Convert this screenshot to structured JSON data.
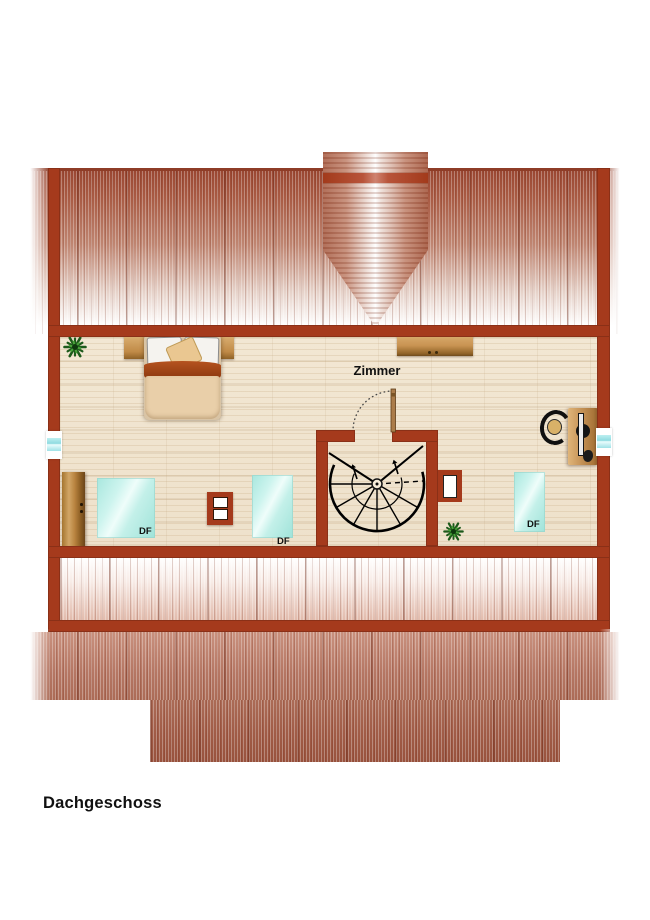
{
  "title": "Dachgeschoss",
  "room": {
    "label": "Zimmer"
  },
  "skylights": [
    {
      "label": "DF"
    },
    {
      "label": "DF"
    },
    {
      "label": "DF"
    }
  ],
  "icons": {
    "plant_1": "plant-icon",
    "plant_2": "plant-icon",
    "staircase": "spiral-staircase-icon",
    "door_swing": "door-swing-icon"
  },
  "colors": {
    "wall": "#a53a1c",
    "roof_dark": "#9a4732",
    "roof_light": "#e6d2c9",
    "floor": "#f1e6d2",
    "skylight": "#bfece6",
    "wood": "#c89455",
    "blanket": "#a8471a",
    "plant": "#2a6d26",
    "text": "#111111"
  }
}
